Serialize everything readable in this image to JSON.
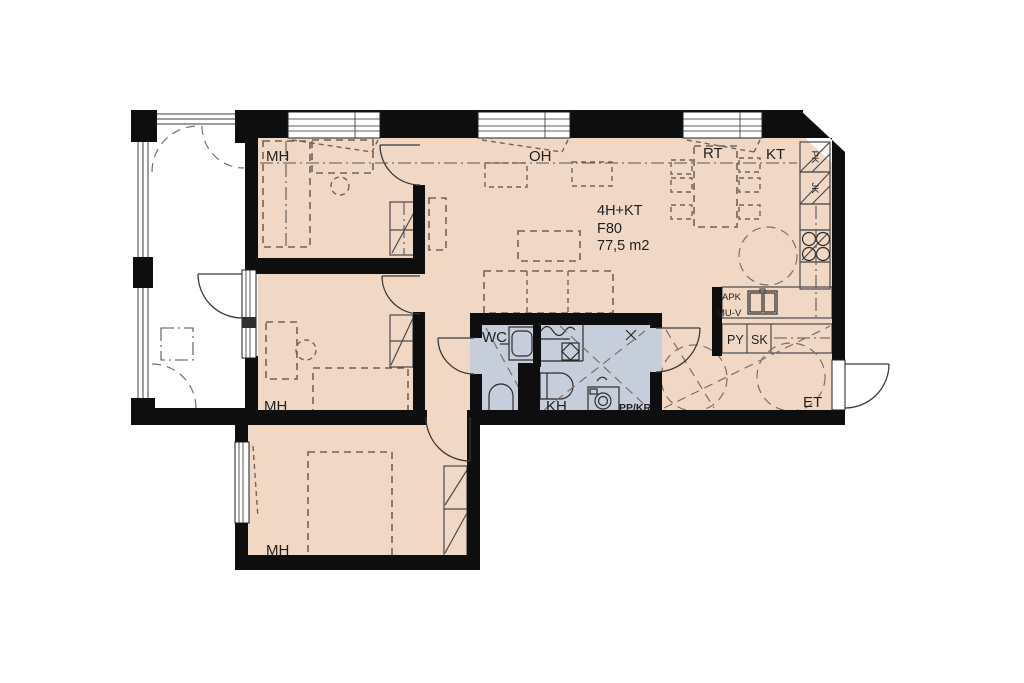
{
  "unit": {
    "type": "4H+KT",
    "code": "F80",
    "area": "77,5 m2"
  },
  "rooms": {
    "bedroom": "MH",
    "living": "OH",
    "dining": "RT",
    "kitchen": "KT",
    "toilet": "WC",
    "bathroom": "KH",
    "entry": "ET"
  },
  "appliances": {
    "freezer": "PK",
    "fridge": "JK",
    "dishwasher": "APK",
    "reservation": "MU-V",
    "laundry_closet": "PY",
    "cleaning_closet": "SK",
    "washer_dryer": "PP/KR"
  },
  "colors": {
    "floor": "#f1d8c5",
    "wet_floor": "#c6cedb",
    "wall": "#0e0e0e",
    "balcony": "#ffffff"
  }
}
